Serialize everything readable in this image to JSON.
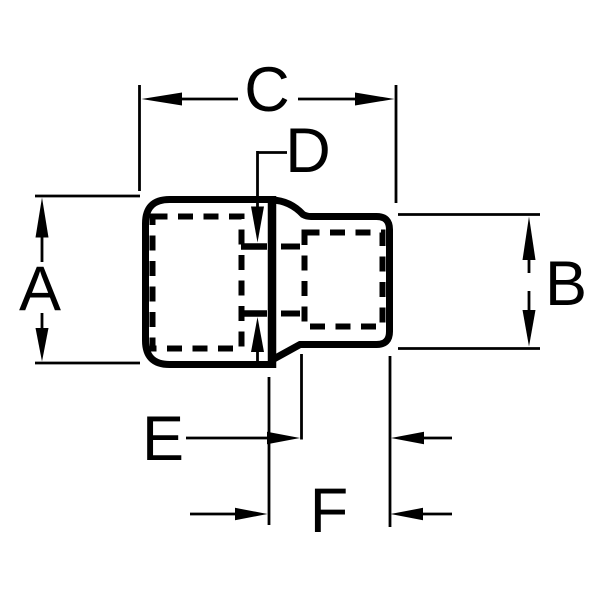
{
  "page": {
    "background_color": "#ffffff",
    "ink_color": "#000000"
  },
  "diagram": {
    "kind": "technical dimension drawing",
    "subject": "stepped socket / adapter side profile with hidden (dashed) bores",
    "labels": {
      "a": "A",
      "b": "B",
      "c": "C",
      "d": "D",
      "e": "E",
      "f": "F"
    },
    "dimensions": [
      {
        "label": "A",
        "placement": "left",
        "orientation": "vertical",
        "indicates": "overall height of large end"
      },
      {
        "label": "B",
        "placement": "right",
        "orientation": "vertical",
        "indicates": "overall height of small end"
      },
      {
        "label": "C",
        "placement": "top",
        "orientation": "horizontal",
        "indicates": "length from left face to small-end face"
      },
      {
        "label": "D",
        "placement": "center",
        "orientation": "vertical",
        "indicates": "inner square drive opening height"
      },
      {
        "label": "E",
        "placement": "bottom",
        "orientation": "horizontal",
        "indicates": "straight length of small end"
      },
      {
        "label": "F",
        "placement": "bottom",
        "orientation": "horizontal",
        "indicates": "total length of small end with shoulder"
      }
    ]
  }
}
